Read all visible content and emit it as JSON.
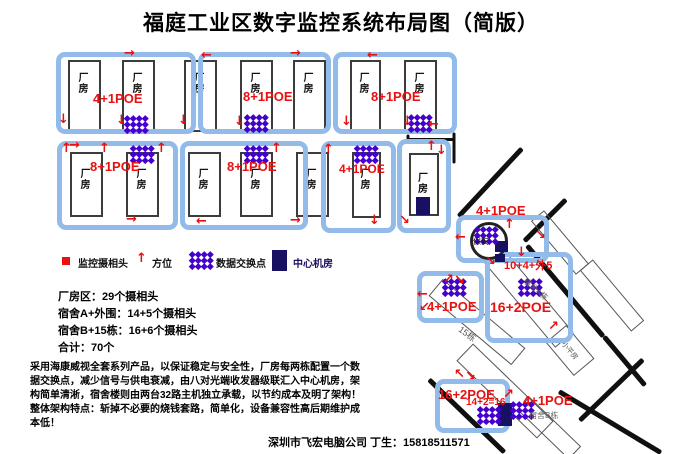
{
  "title": "福庭工业区数字监控系统布局图（简版）",
  "legend": {
    "camera_label": "监控摄相头",
    "direction_label": "方位",
    "switch_label": "数据交换点",
    "server_room_label": "中心机房"
  },
  "labels": {
    "factory_building": "厂房",
    "security_booth": "保安",
    "dorm_a_name": "宿舍A栋",
    "dorm_b_name": "宿舍B栋",
    "building15_name": "15栋",
    "small_house_name": "小平房"
  },
  "icons": {
    "arrow_up": "↑",
    "arrow_down": "↓",
    "arrow_left": "←",
    "arrow_right": "→",
    "arrow_up_right": "↗",
    "arrow_down_right": "↘",
    "arrow_up_left": "↖",
    "arrow_down_left": "↙",
    "camera_square": "■"
  },
  "factory_blocks": [
    {
      "label": "4+1POE"
    },
    {
      "label": "8+1POE"
    },
    {
      "label": "8+1POE"
    },
    {
      "label": "8+1POE"
    },
    {
      "label": "8+1POE"
    },
    {
      "label": "4+1POE"
    }
  ],
  "dorm_area": {
    "security_poe": "4+1POE",
    "building15_poe": "4+1POE",
    "dorm_a_cameras": "10+4+外5",
    "dorm_a_poe": "16+2POE",
    "dorm_b_poe": "16+2POE",
    "dorm_b_note": "14+2=16",
    "dorm_b_poe2": "4+1POE"
  },
  "summary": {
    "factory": "厂房区：29个摄相头",
    "dorm_a": "宿舍A+外围：14+5个摄相头",
    "dorm_b": "宿舍B+15栋：16+6个摄相头",
    "total": "合计：70个"
  },
  "description": "采用海康威视全套系列产品，以保证稳定与安全性，厂房每两栋配置一个数据交换点，减少信号与供电衰减，由八对光端收发器级联汇入中心机房，架构简单清淅，宿舍楼则由两台32路主机独立承载，以节约成本及明了架构！ 整体架构特点：斩掉不必要的烧钱套路，简单化，设备兼容性高后期维护成本低！",
  "footer": "深圳市飞宏电脑公司 丁生：15818511571",
  "colors": {
    "block_blue": "#93bbe9",
    "marker_red": "#e81010",
    "switch_purple": "#4400cc",
    "server_navy": "#181060"
  },
  "map": {
    "arrows": [
      {
        "dir": "right",
        "x": 124,
        "y": 47
      },
      {
        "dir": "down",
        "x": 58,
        "y": 113
      },
      {
        "dir": "down",
        "x": 116,
        "y": 114
      },
      {
        "dir": "down",
        "x": 178,
        "y": 114
      },
      {
        "dir": "left",
        "x": 201,
        "y": 49
      },
      {
        "dir": "right",
        "x": 290,
        "y": 47
      },
      {
        "dir": "down",
        "x": 234,
        "y": 115
      },
      {
        "dir": "down",
        "x": 341,
        "y": 115
      },
      {
        "dir": "left",
        "x": 367,
        "y": 49
      },
      {
        "dir": "down",
        "x": 402,
        "y": 115
      },
      {
        "dir": "left",
        "x": 428,
        "y": 118
      },
      {
        "dir": "up",
        "x": 61,
        "y": 142
      },
      {
        "dir": "right",
        "x": 69,
        "y": 139
      },
      {
        "dir": "up",
        "x": 99,
        "y": 142
      },
      {
        "dir": "up",
        "x": 156,
        "y": 142
      },
      {
        "dir": "right",
        "x": 126,
        "y": 213
      },
      {
        "dir": "up",
        "x": 271,
        "y": 142
      },
      {
        "dir": "left",
        "x": 196,
        "y": 215
      },
      {
        "dir": "right",
        "x": 290,
        "y": 214
      },
      {
        "dir": "up",
        "x": 323,
        "y": 143
      },
      {
        "dir": "down",
        "x": 369,
        "y": 214
      },
      {
        "dir": "up",
        "x": 426,
        "y": 140
      },
      {
        "dir": "down",
        "x": 436,
        "y": 144
      },
      {
        "dir": "down_right",
        "x": 399,
        "y": 214
      },
      {
        "dir": "up",
        "x": 504,
        "y": 218
      },
      {
        "dir": "left",
        "x": 455,
        "y": 231
      },
      {
        "dir": "down_right",
        "x": 535,
        "y": 229
      },
      {
        "dir": "down_right",
        "x": 485,
        "y": 255
      },
      {
        "dir": "down",
        "x": 516,
        "y": 246
      },
      {
        "dir": "up_right",
        "x": 548,
        "y": 320
      },
      {
        "dir": "up_right",
        "x": 443,
        "y": 273
      },
      {
        "dir": "down_right",
        "x": 454,
        "y": 274
      },
      {
        "dir": "left",
        "x": 417,
        "y": 288
      },
      {
        "dir": "down_left",
        "x": 419,
        "y": 301
      },
      {
        "dir": "up_left",
        "x": 454,
        "y": 368
      },
      {
        "dir": "down_right",
        "x": 465,
        "y": 370
      },
      {
        "dir": "up_right",
        "x": 503,
        "y": 388
      }
    ],
    "switch_points": [
      {
        "x": 125,
        "y": 116
      },
      {
        "x": 245,
        "y": 115
      },
      {
        "x": 409,
        "y": 115
      },
      {
        "x": 131,
        "y": 146
      },
      {
        "x": 245,
        "y": 146
      },
      {
        "x": 355,
        "y": 146
      },
      {
        "x": 475,
        "y": 227
      },
      {
        "x": 519,
        "y": 279
      },
      {
        "x": 443,
        "y": 279
      },
      {
        "x": 478,
        "y": 407
      },
      {
        "x": 511,
        "y": 402
      }
    ]
  }
}
